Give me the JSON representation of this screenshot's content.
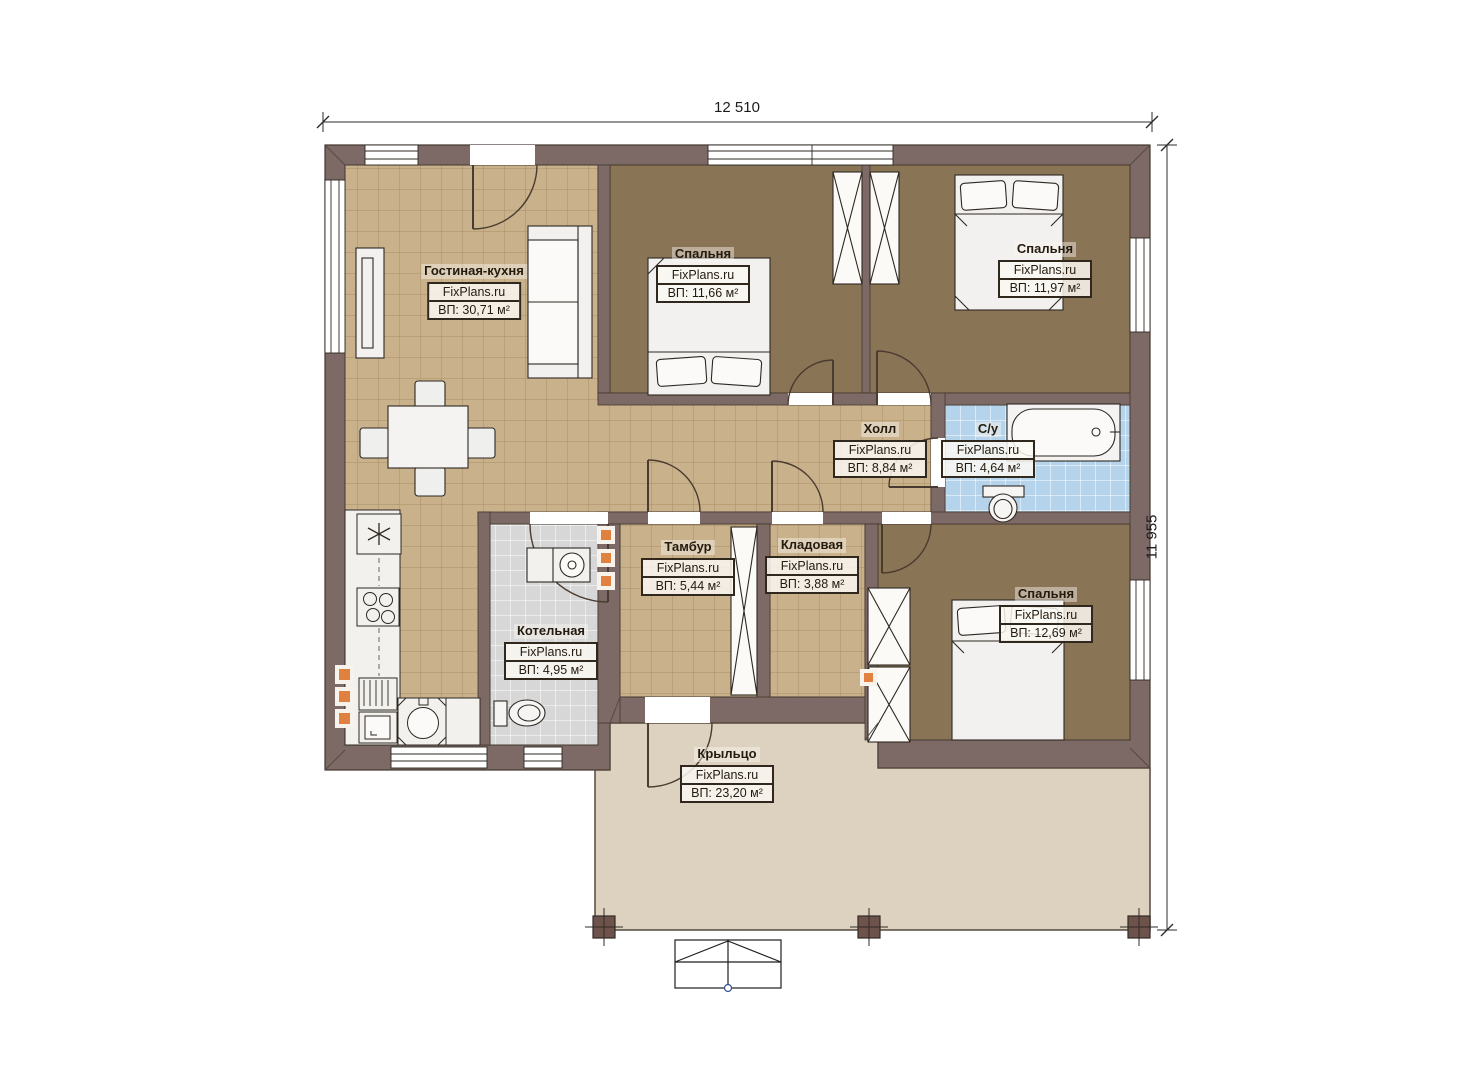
{
  "plan": {
    "watermark": "FixPlans.ru",
    "dimensions": {
      "width_label": "12 510",
      "height_label": "11 955"
    },
    "rooms": [
      {
        "name": "Гостиная-кухня",
        "area": "ВП: 30,71 м²"
      },
      {
        "name": "Спальня",
        "area": "ВП: 11,66 м²"
      },
      {
        "name": "Спальня",
        "area": "ВП: 11,97 м²"
      },
      {
        "name": "Холл",
        "area": "ВП: 8,84 м²"
      },
      {
        "name": "С/у",
        "area": "ВП: 4,64 м²"
      },
      {
        "name": "Тамбур",
        "area": "ВП: 5,44 м²"
      },
      {
        "name": "Кладовая",
        "area": "ВП: 3,88 м²"
      },
      {
        "name": "Котельная",
        "area": "ВП: 4,95 м²"
      },
      {
        "name": "Спальня",
        "area": "ВП: 12,69 м²"
      },
      {
        "name": "Крыльцо",
        "area": "ВП: 23,20 м²"
      }
    ],
    "colors": {
      "wall": "#7d6965",
      "tile_floor": "#c9b18c",
      "bedroom_floor": "#8a7456",
      "bathroom_tile": "#b6d3ec",
      "utility_tile": "#d7d7d7",
      "porch_floor": "#ddd1c0",
      "accent_orange": "#e0813f"
    }
  }
}
